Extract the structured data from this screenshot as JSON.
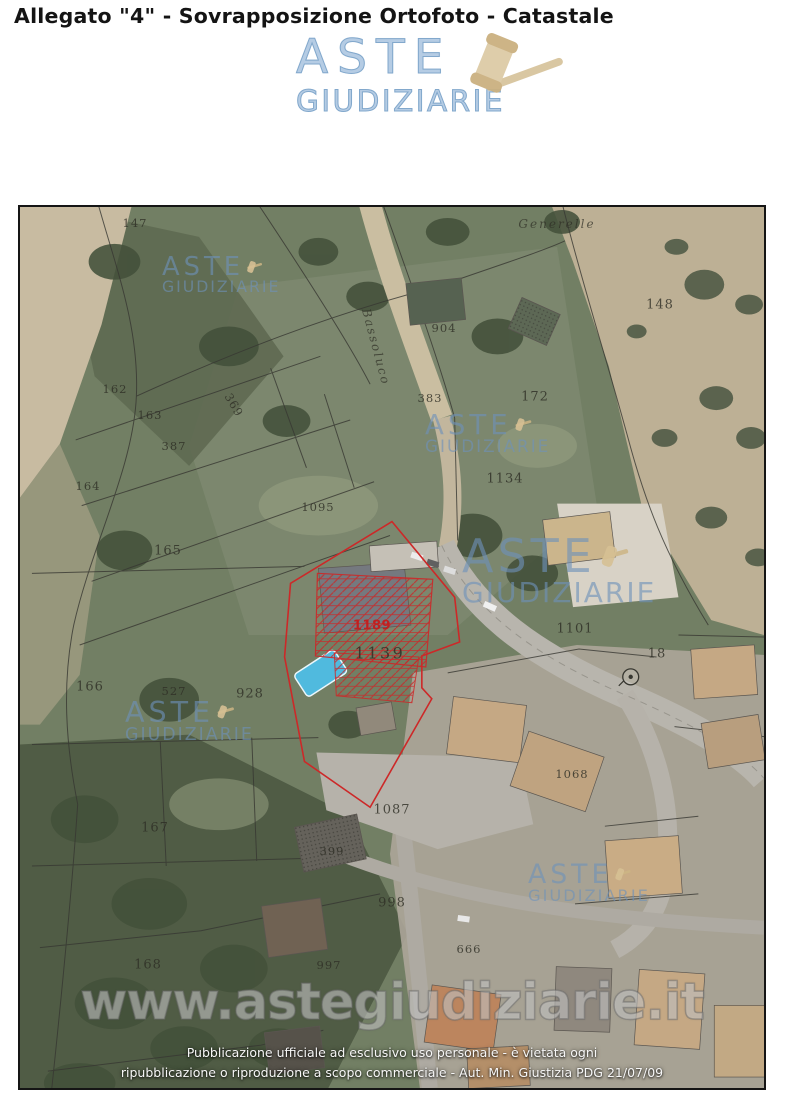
{
  "page": {
    "title": "Allegato \"4\" - Sovrapposizione Ortofoto - Catastale"
  },
  "logo": {
    "line1": "ASTE",
    "line2": "GIUDIZIARIE",
    "icon": "gavel-icon",
    "color": "#9ebddc"
  },
  "map": {
    "kind": "ortofoto with cadastral overlay",
    "subject_parcel": {
      "red_label": "1189",
      "black_label": "1139",
      "outline_color": "#c41d1d",
      "pool_color": "#49b8dd"
    },
    "locality_label": "Generelle",
    "road_label": "Bassoluco",
    "parcels": [
      {
        "t": "147",
        "x": 115,
        "y": 16
      },
      {
        "t": "Generelle",
        "x": 537,
        "y": 17,
        "cls": "road",
        "s": 12
      },
      {
        "t": "148",
        "x": 640,
        "y": 98,
        "s": 13
      },
      {
        "t": "904",
        "x": 424,
        "y": 121
      },
      {
        "t": "Bassoluco",
        "x": 356,
        "y": 140,
        "r": 75,
        "cls": "road",
        "s": 12
      },
      {
        "t": "162",
        "x": 95,
        "y": 182
      },
      {
        "t": "163",
        "x": 130,
        "y": 208
      },
      {
        "t": "369",
        "x": 214,
        "y": 198,
        "r": 60
      },
      {
        "t": "383",
        "x": 410,
        "y": 191
      },
      {
        "t": "172",
        "x": 515,
        "y": 190,
        "s": 13
      },
      {
        "t": "387",
        "x": 154,
        "y": 239
      },
      {
        "t": "164",
        "x": 68,
        "y": 279
      },
      {
        "t": "1134",
        "x": 485,
        "y": 272,
        "s": 13
      },
      {
        "t": "1095",
        "x": 298,
        "y": 300
      },
      {
        "t": "165",
        "x": 148,
        "y": 344,
        "s": 13
      },
      {
        "t": "1101",
        "x": 555,
        "y": 422,
        "s": 13
      },
      {
        "t": "1189",
        "x": 352,
        "y": 419,
        "s": 13,
        "cls": "red"
      },
      {
        "t": "1139",
        "x": 360,
        "y": 446,
        "s": 16,
        "cls": "big"
      },
      {
        "t": "18",
        "x": 637,
        "y": 447,
        "s": 13
      },
      {
        "t": "166",
        "x": 70,
        "y": 480,
        "s": 13
      },
      {
        "t": "527",
        "x": 154,
        "y": 484
      },
      {
        "t": "928",
        "x": 230,
        "y": 487,
        "s": 13
      },
      {
        "t": "1068",
        "x": 552,
        "y": 567
      },
      {
        "t": "1087",
        "x": 372,
        "y": 603,
        "s": 13
      },
      {
        "t": "167",
        "x": 135,
        "y": 621,
        "s": 13
      },
      {
        "t": "399",
        "x": 312,
        "y": 644
      },
      {
        "t": "998",
        "x": 372,
        "y": 696,
        "s": 13
      },
      {
        "t": "666",
        "x": 449,
        "y": 742
      },
      {
        "t": "997",
        "x": 309,
        "y": 758
      },
      {
        "t": "168",
        "x": 128,
        "y": 758,
        "s": 13
      }
    ],
    "watermark": {
      "line1": "ASTE",
      "line2": "GIUDIZIARIE",
      "instances": [
        {
          "x": 142,
          "y": 48,
          "s": 0.56
        },
        {
          "x": 405,
          "y": 205,
          "s": 0.6
        },
        {
          "x": 442,
          "y": 328,
          "s": 1.0
        },
        {
          "x": 105,
          "y": 492,
          "s": 0.62
        },
        {
          "x": 508,
          "y": 655,
          "s": 0.58
        }
      ]
    },
    "symbols": [
      {
        "type": "survey-point-circle",
        "x": 614,
        "y": 472,
        "near_parcel": "18"
      }
    ],
    "url_watermark": "www.astegiudiziarie.it",
    "footer_line1": "Pubblicazione ufficiale ad esclusivo uso personale - è vietata ogni",
    "footer_line2": "ripubblicazione o riproduzione a scopo commerciale - Aut. Min. Giustizia PDG 21/07/09"
  }
}
